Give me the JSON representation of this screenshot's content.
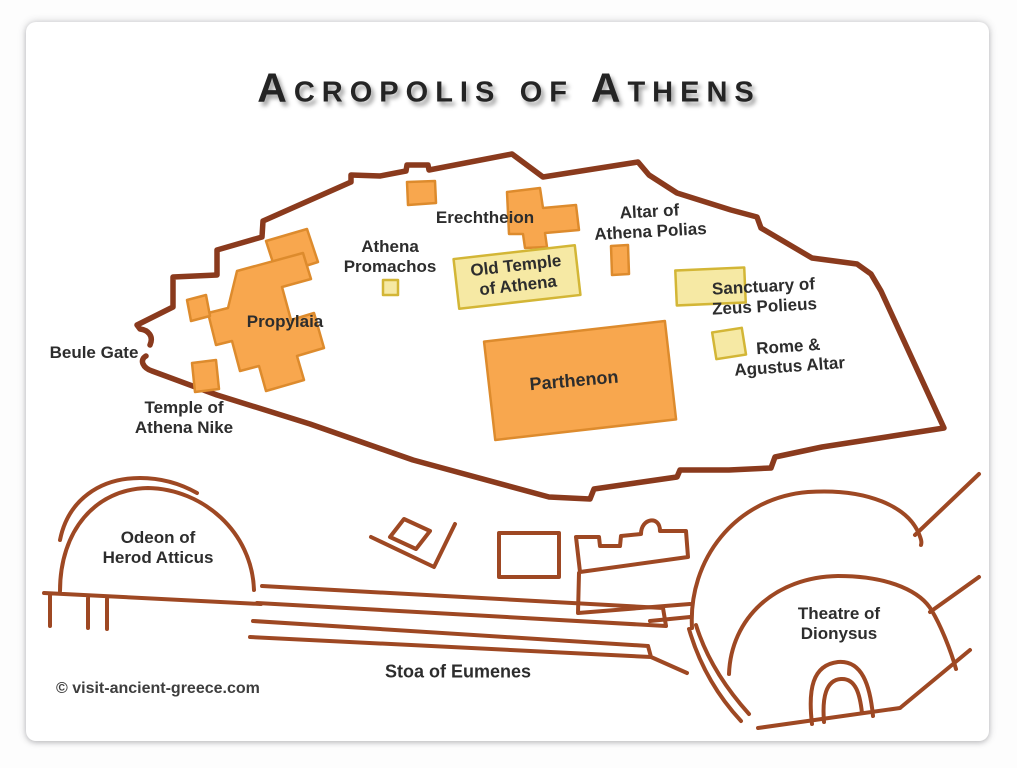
{
  "title": "Acropolis of Athens",
  "copyright": "© visit-ancient-greece.com",
  "colors": {
    "wall": "#8a3a1d",
    "structures": "#9e4823",
    "building_fill": "#f8a74e",
    "building_stroke": "#dd8b2d",
    "sacred_fill": "#f6e9a4",
    "sacred_stroke": "#d3b636",
    "label": "#2d2d2d",
    "title": "#242424",
    "copyright": "#3e3e3e"
  },
  "labels": {
    "beule_gate": "Beule Gate",
    "temple_athena_nike": "Temple of\nAthena Nike",
    "propylaia": "Propylaia",
    "athena_promachos": "Athena\nPromachos",
    "erechtheion": "Erechtheion",
    "old_temple_of_athena": "Old Temple\nof Athena",
    "altar_of_athena_polias": "Altar of\nAthena Polias",
    "sanctuary_of_zeus_polieus": "Sanctuary of\nZeus Polieus",
    "rome_agustus_altar": "Rome &\nAgustus Altar",
    "parthenon": "Parthenon",
    "odeon_of_herod_atticus": "Odeon of\nHerod Atticus",
    "theatre_of_dionysus": "Theatre of\nDionysus",
    "stoa_of_eumenes": "Stoa of Eumenes"
  }
}
